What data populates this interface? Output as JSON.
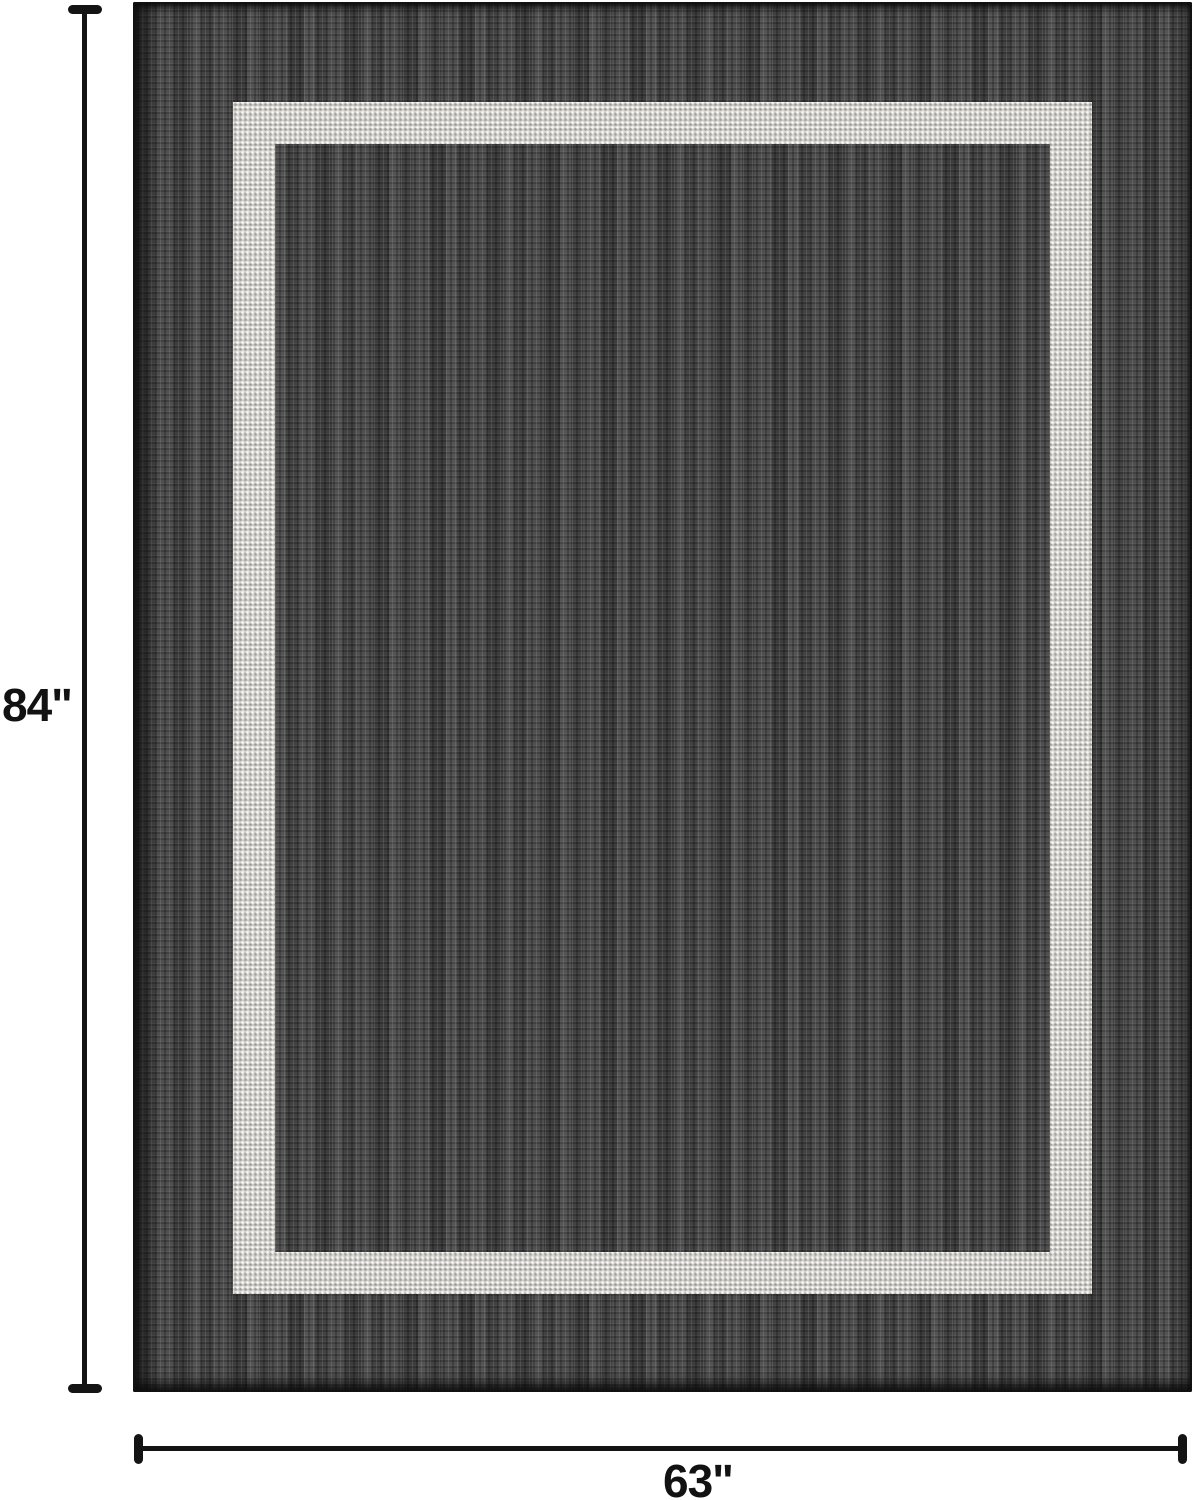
{
  "figure": {
    "description": "Product dimension diagram of a charcoal flat-weave rug with a light gray border stripe",
    "height_label": "84\"",
    "width_label": "63\"",
    "height_inches": 84,
    "width_inches": 63
  },
  "colors": {
    "background": "#ffffff",
    "rug_field": "#494949",
    "rug_stripe": "#d9d6d1",
    "rug_edge": "#141414",
    "dimension": "#141414",
    "label_text": "#121212"
  }
}
